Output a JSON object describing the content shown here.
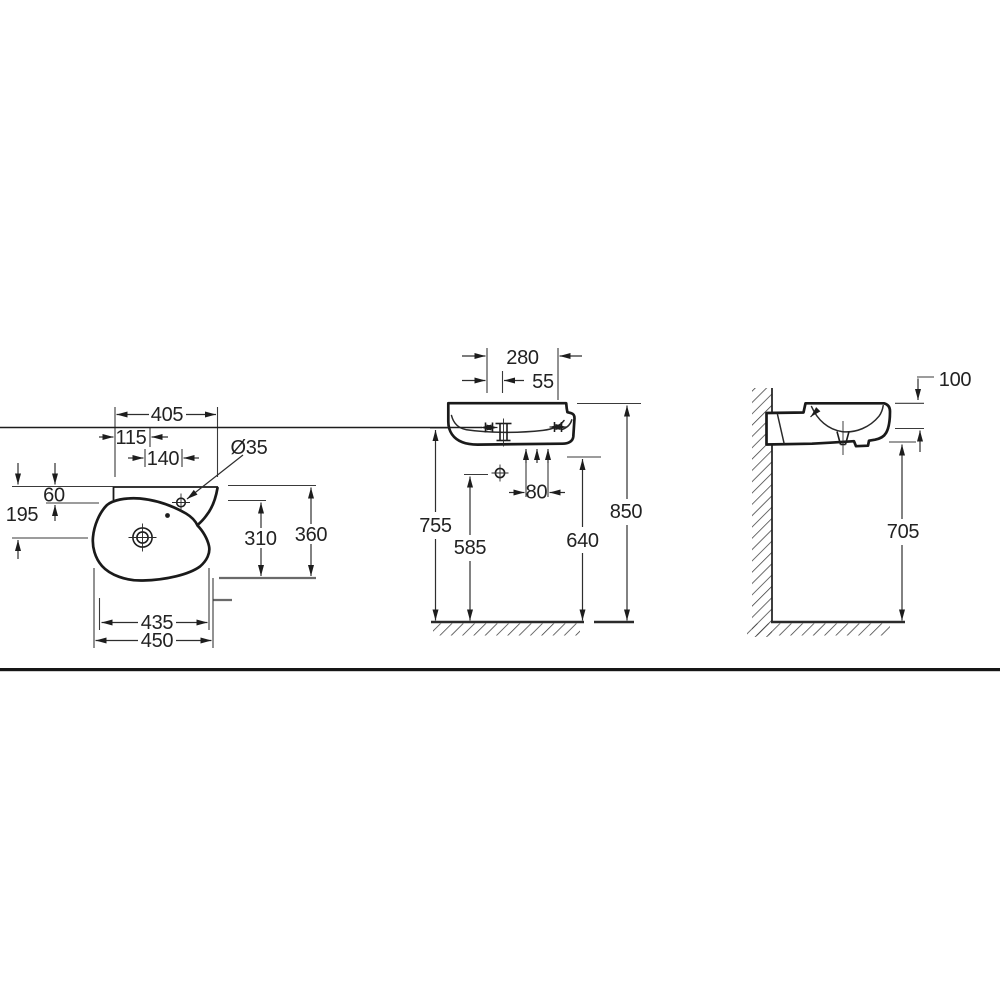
{
  "dimensions": {
    "plan": {
      "top_width": "405",
      "hole_offset": "115",
      "hole_spacing": "140",
      "hole_diameter": "Ø35",
      "rim_to_hole": "60",
      "rim_to_drain": "195",
      "inner_depth": "310",
      "total_depth": "360",
      "bottom_width": "435",
      "overall_width": "450"
    },
    "front": {
      "tap_hole_spacing": "280",
      "side_offset": "55",
      "fixing_hole_spacing": "80",
      "floor_to_underside": "755",
      "floor_to_lower_fixing": "585",
      "floor_to_fixing": "640",
      "floor_to_rim": "850"
    },
    "side": {
      "apron_height": "100",
      "floor_clearance": "705"
    }
  }
}
